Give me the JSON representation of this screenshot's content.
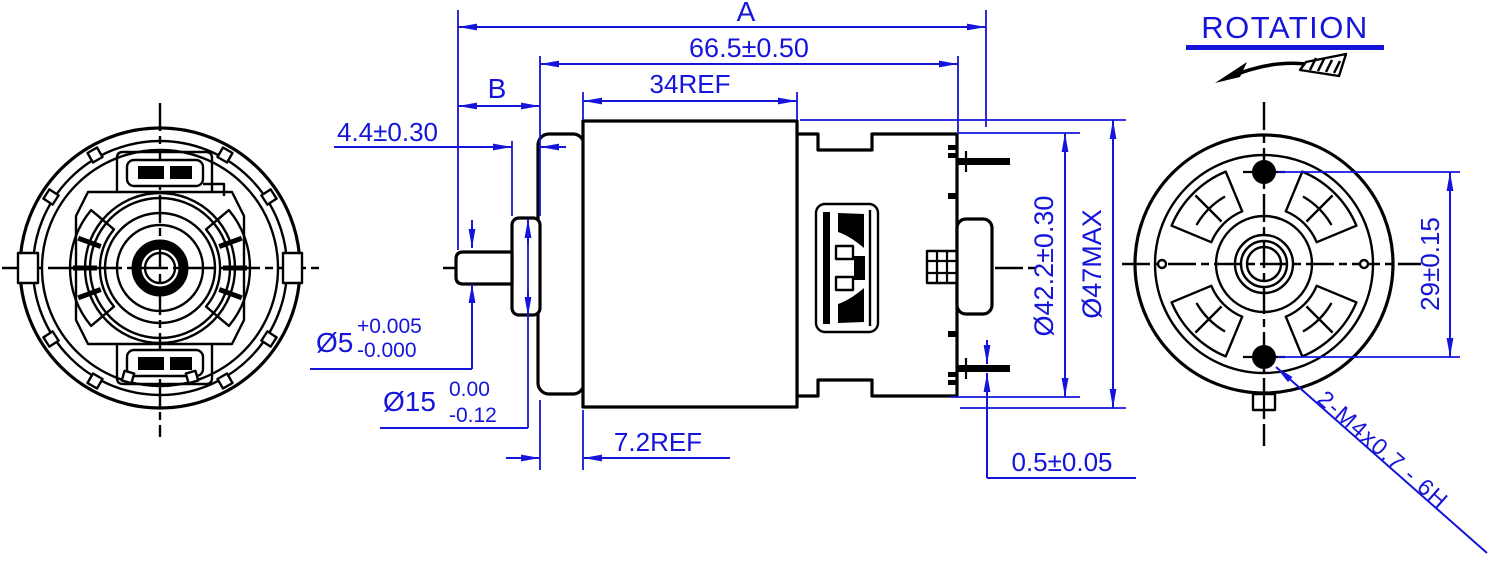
{
  "colors": {
    "dimension": "#1414db",
    "line": "#000000",
    "background": "#ffffff"
  },
  "dimensions": {
    "overall_length": "A",
    "case_length": "66.5±0.50",
    "shaft_extension": "B",
    "body_length": "34REF",
    "boss_thickness": "4.4±0.30",
    "shaft_diameter": {
      "nominal": "Ø5",
      "upper": "+0.005",
      "lower": "-0.000"
    },
    "pilot_diameter": {
      "nominal": "Ø15",
      "upper": "0.00",
      "lower": "-0.12"
    },
    "front_cap_length": "7.2REF",
    "terminal_thickness": "0.5±0.05",
    "endcap_diameter": "Ø42.2±0.30",
    "max_diameter": "Ø47MAX",
    "mounting_hole_spacing": "29±0.15",
    "mounting_thread": "2-M4x0.7 - 6H"
  },
  "annotations": {
    "rotation_label": "ROTATION"
  }
}
